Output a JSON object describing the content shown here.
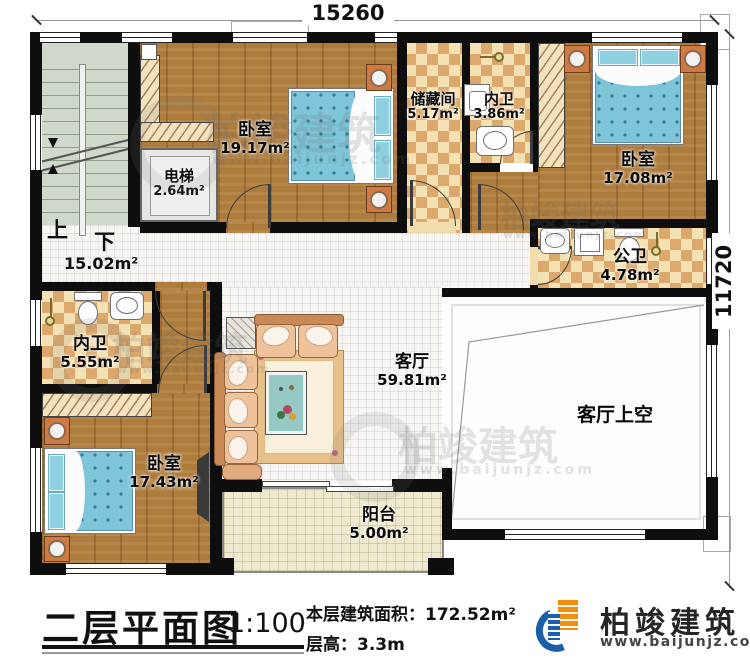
{
  "plan": {
    "title": "二层平面图",
    "scale": "1:100",
    "area_label": "本层建筑面积：",
    "area_value": "172.52m²",
    "height_label": "层高：",
    "height_value": "3.3m"
  },
  "brand": {
    "name": "柏竣建筑",
    "website": "www.baijunjz.com"
  },
  "dims": {
    "top": "15260",
    "right": "11720"
  },
  "stairs": {
    "up": "上",
    "down": "下",
    "hall_area": "15.02m²"
  },
  "rooms": {
    "bedroom_top": {
      "name": "卧室",
      "area": "19.17m²"
    },
    "elevator": {
      "name": "电梯",
      "area": "2.64m²"
    },
    "storage": {
      "name": "储藏间",
      "area": "5.17m²"
    },
    "bath_top": {
      "name": "内卫",
      "area": "3.86m²"
    },
    "bedroom_right": {
      "name": "卧室",
      "area": "17.08m²"
    },
    "bath_public": {
      "name": "公卫",
      "area": "4.78m²"
    },
    "bath_left": {
      "name": "内卫",
      "area": "5.55m²"
    },
    "bedroom_bottom": {
      "name": "卧室",
      "area": "17.43m²"
    },
    "living": {
      "name": "客厅",
      "area": "59.81m²"
    },
    "living_void": {
      "name": "客厅上空"
    },
    "balcony": {
      "name": "阳台",
      "area": "5.00m²"
    }
  },
  "watermark": {
    "text": "柏竣建筑",
    "site": "www.baijunjz.com"
  }
}
